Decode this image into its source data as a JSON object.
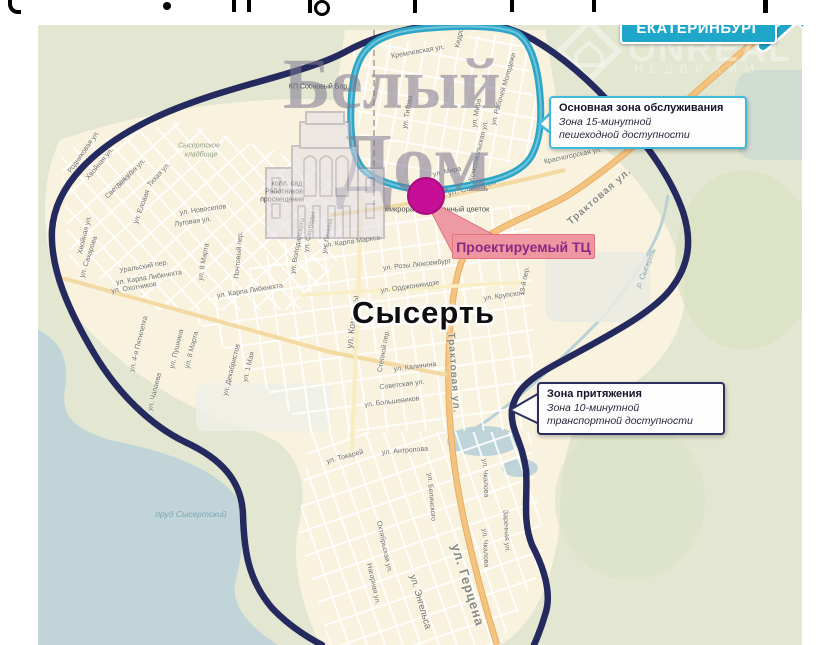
{
  "city_label": "Сысерть",
  "destination": {
    "text": "ЕКАТЕРИНБУРГ",
    "color": "#1fa6cb"
  },
  "project": {
    "text": "Проектируемый ТЦ",
    "bg": "#ef96a1",
    "text_color": "#8b2884",
    "marker_color": "#c60e96"
  },
  "callouts": [
    {
      "title": "Основная зона обслуживания",
      "line1": "Зона 15-минутной",
      "line2": "пешеходной доступности",
      "border": "#3fbadf"
    },
    {
      "title": "Зона притяжения",
      "line1": "Зона 10-минутной",
      "line2": "транспортной доступности",
      "border": "#2b2e5e"
    }
  ],
  "zones": {
    "walk_zone_color": "#2da5c6",
    "drive_zone_color": "#252a5e"
  },
  "watermarks": {
    "brand_line1": "Белый",
    "brand_line2": "Дом",
    "agency_name": "ONREAL",
    "agency_sub": "НЕДВИЖИМ"
  },
  "map_labels": {
    "places": [
      {
        "t": "КП Сосновый Бор",
        "x": 318,
        "y": 87,
        "cls": "poi"
      },
      {
        "t": "Сысертское",
        "x": 199,
        "y": 146,
        "cls": "cem"
      },
      {
        "t": "кладбище",
        "x": 201,
        "y": 155,
        "cls": "cem"
      },
      {
        "t": "колл. сад",
        "x": 287,
        "y": 184,
        "cls": "poi"
      },
      {
        "t": "Работников",
        "x": 284,
        "y": 192,
        "cls": "poi"
      },
      {
        "t": "просвещения",
        "x": 282,
        "y": 200,
        "cls": "poi"
      },
      {
        "t": "микрорайон Каменный цветок",
        "x": 437,
        "y": 209,
        "cls": "micro"
      },
      {
        "t": "пруд Сысертский",
        "x": 191,
        "y": 514,
        "cls": "water"
      },
      {
        "t": "р. Сысерть",
        "x": 646,
        "y": 268,
        "r": -68,
        "cls": "water",
        "s": 7.5
      }
    ],
    "streets": [
      {
        "t": "Кремлевская ул.",
        "x": 418,
        "y": 52,
        "r": -10
      },
      {
        "t": "Кедровая ул.",
        "x": 462,
        "y": 27,
        "r": -78
      },
      {
        "t": "ул. Титова",
        "x": 408,
        "y": 112,
        "r": -80
      },
      {
        "t": "ул. Мира",
        "x": 477,
        "y": 113,
        "r": -80
      },
      {
        "t": "ул. Рабочей Молодежи",
        "x": 504,
        "y": 89,
        "r": -74
      },
      {
        "t": "Комсомольская ул.",
        "x": 479,
        "y": 151,
        "r": -76
      },
      {
        "t": "Красногорская ул.",
        "x": 573,
        "y": 156,
        "r": -12
      },
      {
        "t": "Трактовая ул.",
        "x": 600,
        "y": 197,
        "r": -41,
        "s": 10,
        "cls": "road"
      },
      {
        "t": "ул. Самстрой",
        "x": 472,
        "y": 188,
        "r": -14,
        "s": 8
      },
      {
        "t": "ул. Мира",
        "x": 447,
        "y": 172,
        "r": -12
      },
      {
        "t": "Родниковая ул.",
        "x": 84,
        "y": 152,
        "r": -55
      },
      {
        "t": "Хвойная ул.",
        "x": 100,
        "y": 164,
        "r": -50
      },
      {
        "t": "Зеленая ул.",
        "x": 131,
        "y": 174,
        "r": -46
      },
      {
        "t": "Светлая ул.",
        "x": 120,
        "y": 184,
        "r": -46
      },
      {
        "t": "Тихая ул.",
        "x": 159,
        "y": 175,
        "r": -48
      },
      {
        "t": "ул. Еловая",
        "x": 142,
        "y": 207,
        "r": -70
      },
      {
        "t": "Хвойная ул.",
        "x": 85,
        "y": 235,
        "r": -76
      },
      {
        "t": "ул. Сахарова",
        "x": 89,
        "y": 257,
        "r": -72
      },
      {
        "t": "ул. Новоселов",
        "x": 203,
        "y": 210,
        "r": -8
      },
      {
        "t": "Луговая ул.",
        "x": 193,
        "y": 222,
        "r": -8
      },
      {
        "t": "Уральский пер.",
        "x": 144,
        "y": 267,
        "r": -10
      },
      {
        "t": "ул. Карла Либкнехта",
        "x": 149,
        "y": 278,
        "r": -9
      },
      {
        "t": "ул. Охотников",
        "x": 134,
        "y": 288,
        "r": -9
      },
      {
        "t": "Почтовый пер.",
        "x": 239,
        "y": 255,
        "r": -85
      },
      {
        "t": "ул. 8 Марта",
        "x": 204,
        "y": 262,
        "r": -80
      },
      {
        "t": "ул. Карла Либкнехта",
        "x": 250,
        "y": 291,
        "r": -9
      },
      {
        "t": "ул. 4-я Пятилетка",
        "x": 139,
        "y": 344,
        "r": -76
      },
      {
        "t": "ул. Пушкина",
        "x": 177,
        "y": 349,
        "r": -76
      },
      {
        "t": "ул. 8 Марта",
        "x": 192,
        "y": 350,
        "r": -76
      },
      {
        "t": "ул. Чапаева",
        "x": 155,
        "y": 392,
        "r": -76
      },
      {
        "t": "ул. Декабристов",
        "x": 232,
        "y": 370,
        "r": -76
      },
      {
        "t": "ул. 1 Мая",
        "x": 249,
        "y": 367,
        "r": -76
      },
      {
        "t": "ул. Ленина",
        "x": 328,
        "y": 236,
        "r": -80
      },
      {
        "t": "ул. Свободы",
        "x": 310,
        "y": 232,
        "r": -80
      },
      {
        "t": "ул. Володарского",
        "x": 298,
        "y": 246,
        "r": -80
      },
      {
        "t": "ул. Карла Маркса",
        "x": 352,
        "y": 242,
        "r": -8
      },
      {
        "t": "ул. Розы Люксембург",
        "x": 417,
        "y": 265,
        "r": -6
      },
      {
        "t": "ул. Орджоникидзе",
        "x": 410,
        "y": 287,
        "r": -8
      },
      {
        "t": "ул. Крупской",
        "x": 504,
        "y": 296,
        "r": -8
      },
      {
        "t": "13-й пер.",
        "x": 525,
        "y": 281,
        "r": -80
      },
      {
        "t": "ул. Коммуны",
        "x": 353,
        "y": 322,
        "r": -83,
        "s": 9
      },
      {
        "t": "Степной пер.",
        "x": 384,
        "y": 351,
        "r": -80
      },
      {
        "t": "ул. Калинина",
        "x": 415,
        "y": 367,
        "r": -7
      },
      {
        "t": "Советская ул.",
        "x": 402,
        "y": 385,
        "r": -7
      },
      {
        "t": "ул. Большевиков",
        "x": 392,
        "y": 402,
        "r": -7
      },
      {
        "t": "Трактовая ул.",
        "x": 453,
        "y": 373,
        "r": 86,
        "s": 10,
        "cls": "road"
      },
      {
        "t": "ул. Токарей",
        "x": 345,
        "y": 457,
        "r": -15
      },
      {
        "t": "ул. Антропова",
        "x": 405,
        "y": 451,
        "r": -5
      },
      {
        "t": "ул. Белинского",
        "x": 431,
        "y": 497,
        "r": 85
      },
      {
        "t": "Октябрьская ул.",
        "x": 384,
        "y": 547,
        "r": 78
      },
      {
        "t": "Нагорная ул.",
        "x": 373,
        "y": 584,
        "r": 78
      },
      {
        "t": "ул. Энгельса",
        "x": 420,
        "y": 602,
        "r": 74,
        "s": 9.5
      },
      {
        "t": "ул. Герцена",
        "x": 468,
        "y": 585,
        "r": 73,
        "s": 13,
        "cls": "road"
      },
      {
        "t": "ул. Чкалова",
        "x": 485,
        "y": 478,
        "r": 87
      },
      {
        "t": "ул. Чкалова",
        "x": 485,
        "y": 548,
        "r": 87
      },
      {
        "t": "Заречная ул.",
        "x": 506,
        "y": 531,
        "r": 87
      }
    ]
  }
}
